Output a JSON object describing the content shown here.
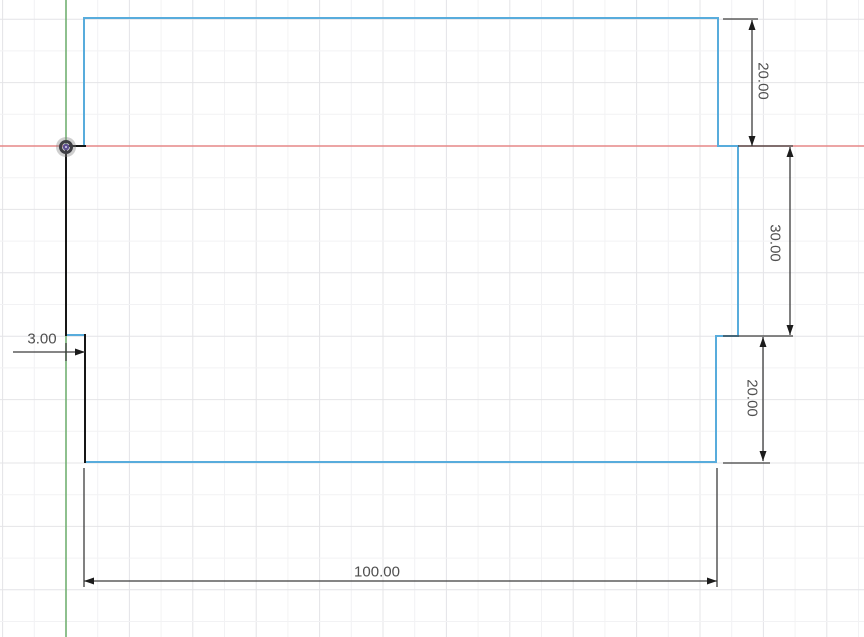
{
  "canvas": {
    "width": 864,
    "height": 637,
    "background": "#ffffff"
  },
  "grid": {
    "origin_x": 66,
    "origin_y": 146,
    "minor_spacing": 31.7,
    "major_every": 2,
    "minor_color": "#f2f2f4",
    "major_color": "#e4e4e7"
  },
  "axes": {
    "x_axis": {
      "y": 146,
      "color": "#e58787"
    },
    "y_axis": {
      "x": 66,
      "color": "#72b072"
    }
  },
  "origin_marker": {
    "x": 66,
    "y": 147,
    "halo_color": "rgba(130,130,130,0.38)",
    "ring_color": "#3e3e44",
    "center_color": "#5d4f91",
    "dot_color": "#d9d2ee"
  },
  "sketch": {
    "line_colors": {
      "unconstrained": "#58acdc",
      "constrained": "#161616"
    },
    "segments": [
      {
        "x1": 84,
        "y1": 18,
        "x2": 718,
        "y2": 18,
        "constraint": "unconstrained"
      },
      {
        "x1": 84,
        "y1": 18,
        "x2": 84,
        "y2": 146,
        "constraint": "unconstrained"
      },
      {
        "x1": 718,
        "y1": 18,
        "x2": 718,
        "y2": 146,
        "constraint": "unconstrained"
      },
      {
        "x1": 718,
        "y1": 146,
        "x2": 738,
        "y2": 146,
        "constraint": "unconstrained"
      },
      {
        "x1": 738,
        "y1": 146,
        "x2": 738,
        "y2": 336,
        "constraint": "unconstrained"
      },
      {
        "x1": 738,
        "y1": 336,
        "x2": 716,
        "y2": 336,
        "constraint": "unconstrained"
      },
      {
        "x1": 716,
        "y1": 336,
        "x2": 716,
        "y2": 462,
        "constraint": "unconstrained"
      },
      {
        "x1": 85,
        "y1": 462,
        "x2": 716,
        "y2": 462,
        "constraint": "unconstrained"
      },
      {
        "x1": 66,
        "y1": 335,
        "x2": 85,
        "y2": 335,
        "constraint": "unconstrained"
      },
      {
        "x1": 66,
        "y1": 146,
        "x2": 85,
        "y2": 146,
        "constraint": "constrained"
      },
      {
        "x1": 66,
        "y1": 146,
        "x2": 66,
        "y2": 335,
        "constraint": "constrained"
      },
      {
        "x1": 85,
        "y1": 335,
        "x2": 85,
        "y2": 462,
        "constraint": "constrained"
      }
    ]
  },
  "dimension_style": {
    "line_color": "#3c3c3c",
    "text_color": "#4f4f4f",
    "arrow_length": 10,
    "arrow_half_width": 3.5
  },
  "dimensions": [
    {
      "id": "dim-right-top",
      "label": "20.00",
      "witness_lines": [
        [
          723,
          19,
          758,
          19
        ],
        [
          738,
          146,
          793,
          146
        ]
      ],
      "line": [
        752,
        20,
        752,
        146
      ],
      "arrows": [
        {
          "x": 752,
          "y": 20,
          "dir": "up"
        },
        {
          "x": 752,
          "y": 146,
          "dir": "down"
        }
      ],
      "text": {
        "x": 763,
        "y": 81,
        "rotate": 90
      }
    },
    {
      "id": "dim-right-middle",
      "label": "30.00",
      "witness_lines": [
        [
          723,
          336,
          793,
          336
        ]
      ],
      "line": [
        790,
        147,
        790,
        335
      ],
      "arrows": [
        {
          "x": 790,
          "y": 147,
          "dir": "up"
        },
        {
          "x": 790,
          "y": 335,
          "dir": "down"
        }
      ],
      "text": {
        "x": 775,
        "y": 243,
        "rotate": 90
      }
    },
    {
      "id": "dim-right-bottom",
      "label": "20.00",
      "witness_lines": [
        [
          723,
          463,
          770,
          463
        ]
      ],
      "line": [
        763,
        337,
        763,
        461
      ],
      "arrows": [
        {
          "x": 763,
          "y": 337,
          "dir": "up"
        },
        {
          "x": 763,
          "y": 461,
          "dir": "down"
        }
      ],
      "text": {
        "x": 752,
        "y": 398,
        "rotate": 90
      }
    },
    {
      "id": "dim-left-step",
      "label": "3.00",
      "witness_lines": [
        [
          66,
          343,
          66,
          361
        ]
      ],
      "line": [
        13,
        352,
        85,
        352
      ],
      "arrows": [
        {
          "x": 85,
          "y": 352,
          "dir": "right"
        }
      ],
      "text": {
        "x": 42,
        "y": 339,
        "rotate": 0
      }
    },
    {
      "id": "dim-bottom-width",
      "label": "100.00",
      "witness_lines": [
        [
          84,
          468,
          84,
          587
        ],
        [
          717,
          468,
          717,
          587
        ]
      ],
      "line": [
        84,
        581,
        717,
        581
      ],
      "arrows": [
        {
          "x": 84,
          "y": 581,
          "dir": "left"
        },
        {
          "x": 717,
          "y": 581,
          "dir": "right"
        }
      ],
      "text": {
        "x": 377,
        "y": 572,
        "rotate": 0
      }
    }
  ]
}
